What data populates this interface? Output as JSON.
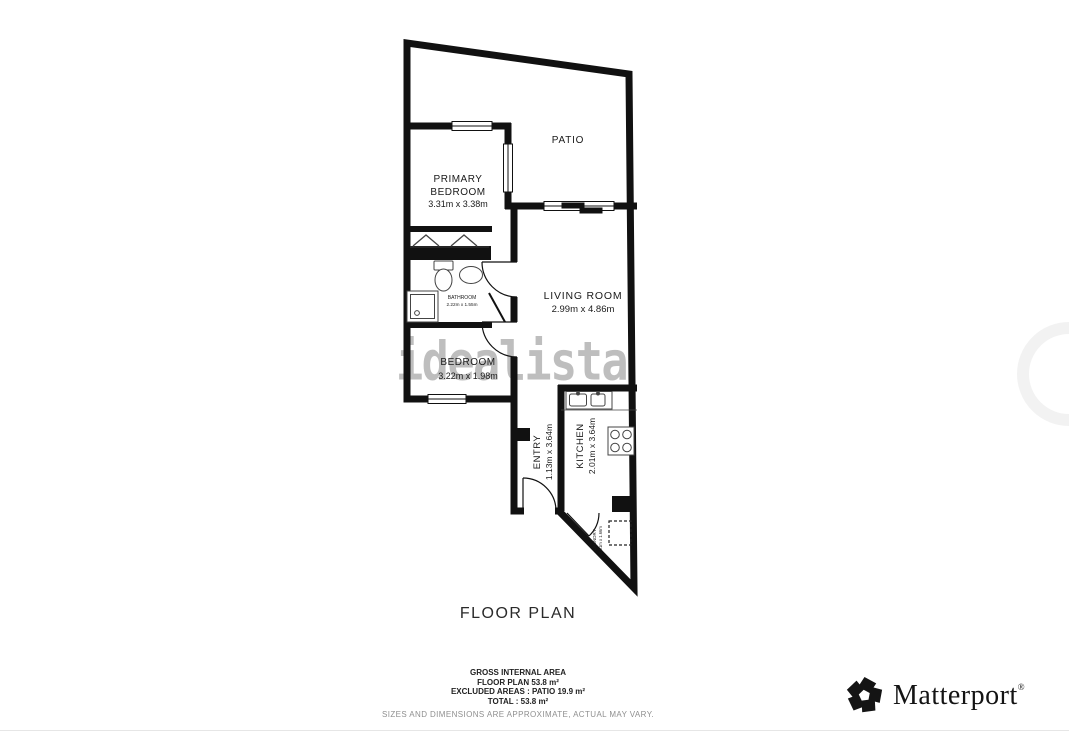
{
  "title": "FLOOR PLAN",
  "watermark": {
    "text": "idealista"
  },
  "plan": {
    "rooms": {
      "patio": {
        "name": "PATIO"
      },
      "primary_bedroom": {
        "line1": "PRIMARY",
        "line2": "BEDROOM",
        "dims": "3.31m x 3.38m"
      },
      "bathroom": {
        "name": "BATHROOM",
        "dims": "2.22m x 1.55m"
      },
      "living_room": {
        "name": "LIVING ROOM",
        "dims": "2.99m x 4.86m"
      },
      "bedroom": {
        "name": "BEDROOM",
        "dims": "3.22m x 1.98m"
      },
      "entry": {
        "name": "ENTRY",
        "dims": "1.13m x 3.64m"
      },
      "kitchen": {
        "name": "KITCHEN",
        "dims": "2.01m x 3.64m"
      },
      "laundry": {
        "name": "LAUNDRY",
        "dims": "2.01m x 1.66m"
      }
    }
  },
  "summary": {
    "gross_label": "GROSS INTERNAL AREA",
    "floor_plan_line": "FLOOR PLAN 53.8 m²",
    "excluded_line": "EXCLUDED AREAS :  PATIO 19.9 m²",
    "total_line": "TOTAL :  53.8 m²",
    "disclaimer": "SIZES AND DIMENSIONS ARE APPROXIMATE, ACTUAL MAY VARY."
  },
  "branding": {
    "name": "Matterport",
    "mark": "®"
  },
  "colors": {
    "wall": "#111111",
    "label_text": "#1a1a1a",
    "watermark": "#7d7d7d",
    "disclaimer_text": "#8f8f8f",
    "logo": "#141414"
  }
}
